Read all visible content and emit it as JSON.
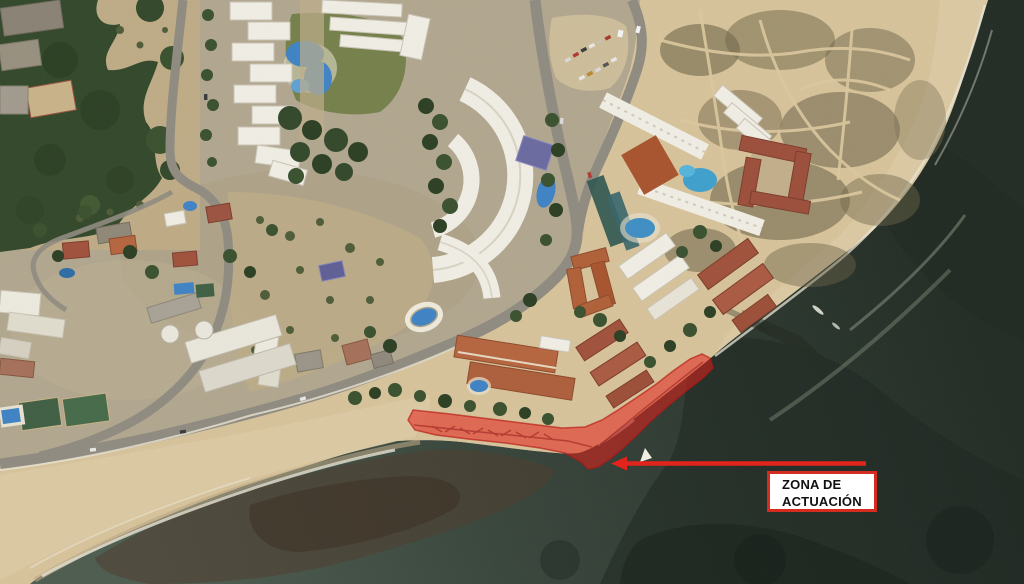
{
  "annotation": {
    "label_line1": "ZONA DE",
    "label_line2": "ACTUACIÓN",
    "zone_fill_color": "#e41e17",
    "zone_stroke_color": "#b51210",
    "leader_line_color": "#e32119",
    "box_border_color": "#d62b1f",
    "box_background_color": "#ffffff",
    "label_text_color": "#111111"
  },
  "scene": {
    "palette": {
      "sea_deep": "#232d24",
      "sea_bay": "#4e5c50",
      "beach_sand": "#d7c39a",
      "dune_sand": "#c2a87f",
      "forest_green": "#33482a",
      "lawn_green": "#75804b",
      "road_gray": "#8f8b80",
      "building_white": "#f0ede4",
      "roof_red": "#a0523c",
      "roof_orange": "#b5653f",
      "pool_blue": "#3f83c4"
    }
  }
}
